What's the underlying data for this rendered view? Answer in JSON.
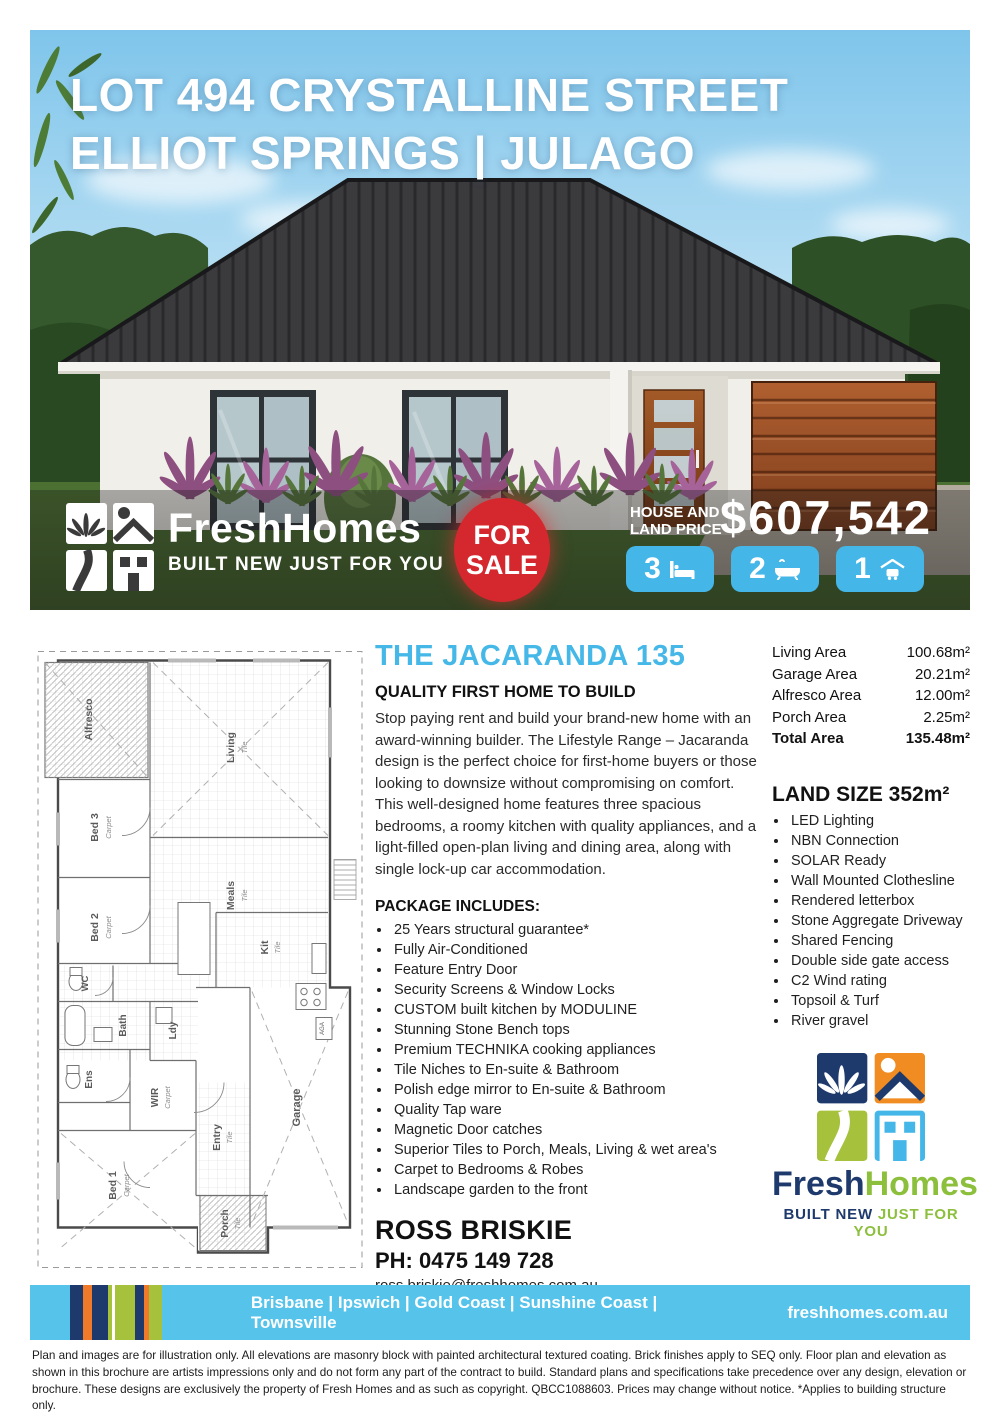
{
  "page": {
    "title_line1": "LOT 494 CRYSTALLINE STREET",
    "title_line2": "ELLIOT SPRINGS | JULAGO"
  },
  "brand": {
    "fresh": "Fresh",
    "homes": "Homes",
    "tagline": "BUILT NEW JUST FOR YOU",
    "tagline_navy": "BUILT NEW ",
    "tagline_green": "JUST FOR YOU"
  },
  "hero": {
    "sale_line1": "FOR",
    "sale_line2": "SALE",
    "price_label1": "HOUSE AND",
    "price_label2": "LAND PRICE",
    "price": "$607,542",
    "stats": [
      {
        "count": "3",
        "icon": "bed-icon"
      },
      {
        "count": "2",
        "icon": "bath-icon"
      },
      {
        "count": "1",
        "icon": "car-icon"
      }
    ]
  },
  "floorplan": {
    "rooms": {
      "alfresco": {
        "label": "Alfresco"
      },
      "living": {
        "label": "Living",
        "floor": "Tile"
      },
      "bed3": {
        "label": "Bed 3",
        "floor": "Carpet"
      },
      "meals": {
        "label": "Meals",
        "floor": "Tile"
      },
      "bed2": {
        "label": "Bed 2",
        "floor": "Carpet"
      },
      "kitchen": {
        "label": "Kit",
        "floor": "Tile"
      },
      "wc": {
        "label": "WC"
      },
      "bath": {
        "label": "Bath"
      },
      "laundry": {
        "label": "Ldy"
      },
      "ensuite": {
        "label": "Ens"
      },
      "wir": {
        "label": "WIR",
        "floor": "Carpet"
      },
      "entry": {
        "label": "Entry",
        "floor": "Tile"
      },
      "garage": {
        "label": "Garage"
      },
      "bed1": {
        "label": "Bed 1",
        "floor": "Carpet"
      },
      "porch": {
        "label": "Porch",
        "floor": "Tile"
      },
      "aga": "AGA"
    }
  },
  "main": {
    "heading": "THE JACARANDA 135",
    "subheading": "QUALITY FIRST HOME TO BUILD",
    "description": "Stop paying rent and build your brand-new home with an award-winning builder. The Lifestyle Range – Jacaranda design is the perfect choice for first-home buyers or those looking to downsize without compromising on comfort. This well-designed home features three spacious bedrooms, a roomy kitchen with quality appliances, and a light-filled open-plan living and dining area, along with single lock-up car accommodation.",
    "package_heading": "PACKAGE INCLUDES:",
    "package_items": [
      "25 Years structural guarantee*",
      "Fully Air-Conditioned",
      "Feature Entry Door",
      "Security Screens & Window Locks",
      "CUSTOM built kitchen by MODULINE",
      "Stunning Stone Bench tops",
      "Premium TECHNIKA cooking appliances",
      "Tile Niches to En-suite & Bathroom",
      "Polish edge mirror to En-suite & Bathroom",
      "Quality Tap ware",
      "Magnetic Door catches",
      "Superior Tiles to Porch, Meals, Living & wet area's",
      "Carpet to Bedrooms & Robes",
      "Landscape garden to the front"
    ]
  },
  "areas": {
    "rows": [
      {
        "label": "Living Area",
        "value": "100.68m²"
      },
      {
        "label": "Garage Area",
        "value": "20.21m²"
      },
      {
        "label": "Alfresco Area",
        "value": "12.00m²"
      },
      {
        "label": "Porch Area",
        "value": "2.25m²"
      }
    ],
    "total_label": "Total Area",
    "total_value": "135.48m²",
    "land_size": "LAND SIZE 352m²"
  },
  "features": [
    "LED Lighting",
    "NBN Connection",
    "SOLAR Ready",
    "Wall Mounted Clothesline",
    "Rendered letterbox",
    "Stone Aggregate Driveway",
    "Shared Fencing",
    "Double side gate access",
    "C2 Wind rating",
    "Topsoil & Turf",
    "River gravel"
  ],
  "contact": {
    "name": "ROSS BRISKIE",
    "phone": "PH: 0475 149 728",
    "email": "ross.briskie@freshhomes.com.au"
  },
  "footer": {
    "locations": "Brisbane | Ipswich | Gold Coast | Sunshine Coast | Townsville",
    "website": "freshhomes.com.au"
  },
  "fine_print": "Plan and images are for illustration only. All elevations are masonry block with painted architectural textured coating. Brick finishes apply to SEQ only. Floor plan and elevation as shown in this brochure are artists impressions only and do not form any part of the contract to build. Standard plans and specifications take precedence over any design, elevation or brochure. These designs are exclusively the property of Fresh Homes and as such as copyright. QBCC1088603. Prices may change without notice. *Applies to building structure only.",
  "colors": {
    "accent_blue": "#45b8e8",
    "footer_blue": "#56c3ea",
    "sale_red": "#d4282e",
    "navy": "#1e3a6d",
    "green": "#8cbf3c",
    "orange": "#f08c21",
    "roof_charcoal": "#3b3b3e"
  }
}
